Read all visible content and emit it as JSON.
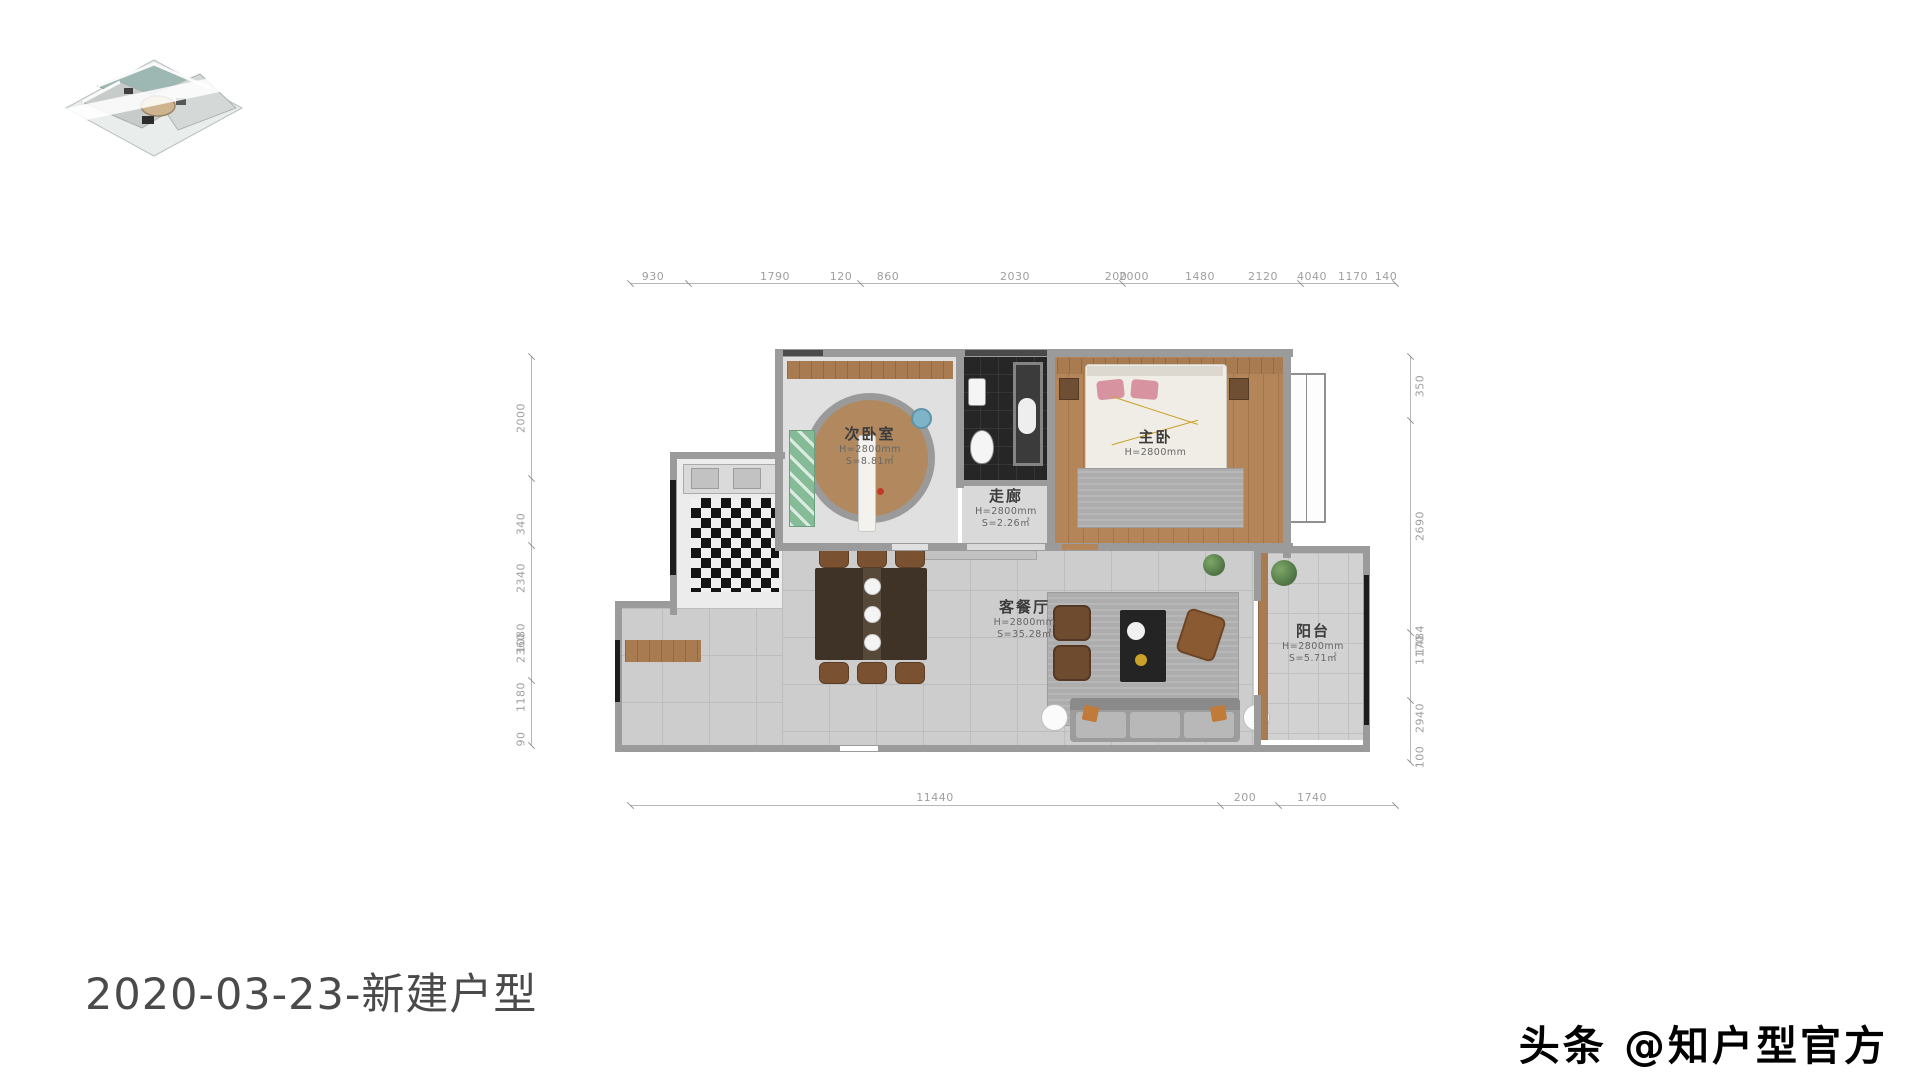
{
  "title": {
    "text": "2020-03-23-新建户型"
  },
  "watermark": {
    "text": "头条 @知户型官方"
  },
  "thumbnail": {
    "label": "3d-floorplan-preview"
  },
  "rooms": {
    "second_bedroom": {
      "name": "次卧室",
      "height": "H=2800mm",
      "area": "S=8.81㎡"
    },
    "corridor": {
      "name": "走廊",
      "height": "H=2800mm",
      "area": "S=2.26㎡"
    },
    "master_bedroom": {
      "name": "主卧",
      "height": "H=2800mm"
    },
    "living_dining": {
      "name": "客餐厅",
      "height": "H=2800mm",
      "area": "S=35.28㎡"
    },
    "balcony": {
      "name": "阳台",
      "height": "H=2800mm",
      "area": "S=5.71㎡"
    }
  },
  "dims": {
    "top": [
      "930",
      "1790",
      "120",
      "860",
      "2030",
      "200",
      "2000",
      "1480",
      "2120",
      "4040",
      "1170",
      "140"
    ],
    "left": [
      "2000",
      "340",
      "2340",
      "1080",
      "2360",
      "1180",
      "90"
    ],
    "right": [
      "350",
      "2690",
      "1484",
      "1170",
      "2940",
      "100"
    ],
    "bottom": [
      "11440",
      "200",
      "1740"
    ]
  },
  "colors": {
    "wall": "#9b9b9b",
    "window_frame": "#1d1d1d",
    "wood_floor": "#b5855a",
    "tile_floor": "#cdcdcd",
    "bath_floor": "#262626",
    "pillow_pink": "#d893a0",
    "dim_text": "#9f9f9f",
    "title_text": "#4a4a4a"
  }
}
